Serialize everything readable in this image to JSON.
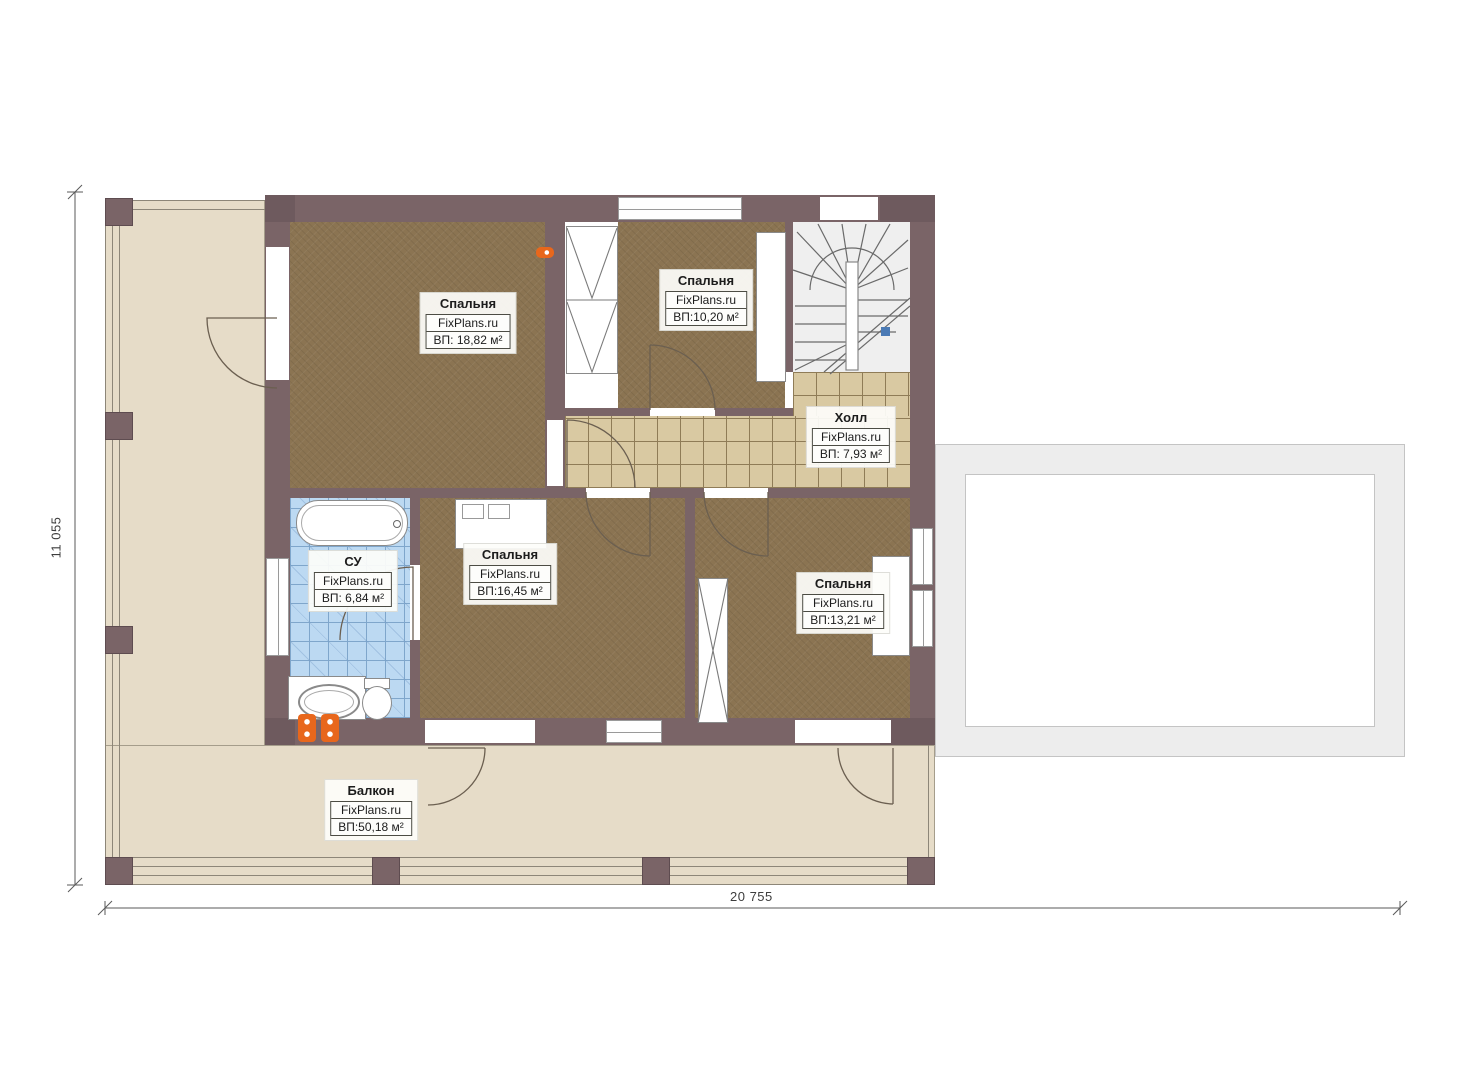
{
  "dimensions": {
    "vertical": "11 055",
    "horizontal": "20 755"
  },
  "rooms": {
    "bedroom_top_left": {
      "name": "Спальня",
      "brand": "FixPlans.ru",
      "area": "ВП: 18,82 м²"
    },
    "bedroom_top_mid": {
      "name": "Спальня",
      "brand": "FixPlans.ru",
      "area": "ВП:10,20 м²"
    },
    "hall": {
      "name": "Холл",
      "brand": "FixPlans.ru",
      "area": "ВП: 7,93 м²"
    },
    "bathroom": {
      "name": "СУ",
      "brand": "FixPlans.ru",
      "area": "ВП: 6,84 м²"
    },
    "bedroom_mid": {
      "name": "Спальня",
      "brand": "FixPlans.ru",
      "area": "ВП:16,45 м²"
    },
    "bedroom_right": {
      "name": "Спальня",
      "brand": "FixPlans.ru",
      "area": "ВП:13,21 м²"
    },
    "balcony": {
      "name": "Балкон",
      "brand": "FixPlans.ru",
      "area": "ВП:50,18 м²"
    }
  },
  "colors": {
    "wall": "#7a6467",
    "bedroom_floor": "#8b7452",
    "hall_tile": "#d9c9a2",
    "bath_tile": "#bcd9f2",
    "balcony_floor": "#e6dcc8",
    "accent_orange": "#e8671c",
    "stair_marker_blue": "#4a7ab5"
  }
}
